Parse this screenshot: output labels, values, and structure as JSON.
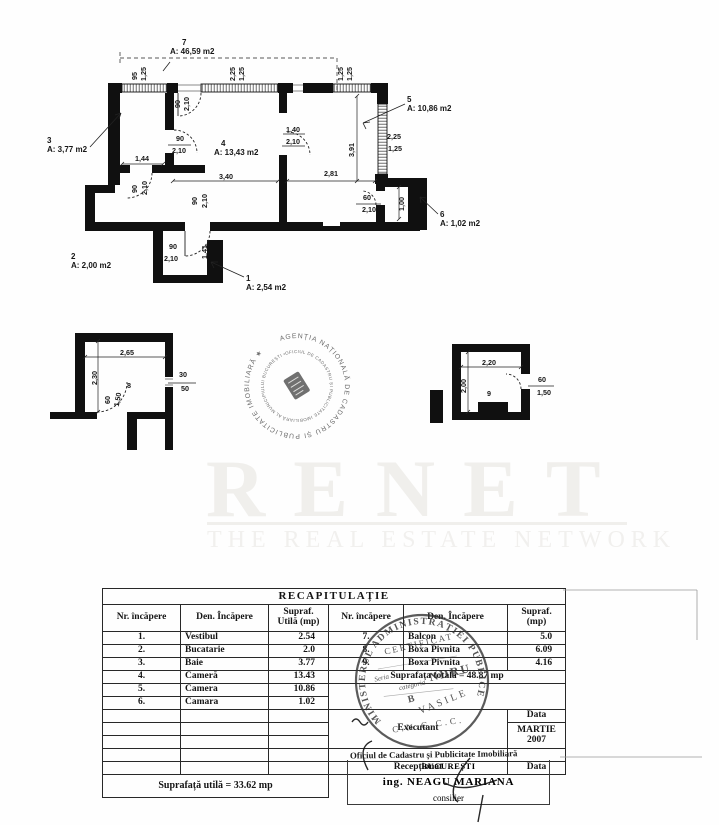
{
  "page": {
    "ink": "#1a1a1a",
    "paper": "#fefefe"
  },
  "watermark": {
    "title": "RENET",
    "subtitle": "THE REAL ESTATE NETWORK"
  },
  "floorplan": {
    "labels": [
      {
        "t": "7",
        "x": 182,
        "y": 45,
        "a": "s",
        "s": 8
      },
      {
        "t": "A: 46,59 m2",
        "x": 170,
        "y": 54,
        "a": "s",
        "s": 8
      },
      {
        "t": "95",
        "x": 137,
        "y": 76,
        "r": -90
      },
      {
        "t": "1,25",
        "x": 146,
        "y": 74,
        "r": -90
      },
      {
        "t": "2,25",
        "x": 235,
        "y": 74,
        "r": -90
      },
      {
        "t": "1,25",
        "x": 244,
        "y": 74,
        "r": -90
      },
      {
        "t": "1,25",
        "x": 343,
        "y": 74,
        "r": -90
      },
      {
        "t": "1,25",
        "x": 352,
        "y": 74,
        "r": -90
      },
      {
        "t": "90",
        "x": 180,
        "y": 104,
        "r": -90
      },
      {
        "t": "2,10",
        "x": 189,
        "y": 104,
        "r": -90
      },
      {
        "t": "3",
        "x": 47,
        "y": 143,
        "a": "s",
        "s": 8
      },
      {
        "t": "A: 3,77 m2",
        "x": 47,
        "y": 152,
        "a": "s",
        "s": 8
      },
      {
        "t": "4",
        "x": 221,
        "y": 146,
        "a": "s",
        "s": 8
      },
      {
        "t": "A: 13,43 m2",
        "x": 214,
        "y": 155,
        "a": "s",
        "s": 8
      },
      {
        "t": "5",
        "x": 407,
        "y": 102,
        "a": "s",
        "s": 8
      },
      {
        "t": "A: 10,86 m2",
        "x": 407,
        "y": 111,
        "a": "s",
        "s": 8
      },
      {
        "t": "1,40",
        "x": 293,
        "y": 132
      },
      {
        "t": "2,10",
        "x": 293,
        "y": 144
      },
      {
        "t": "2,25",
        "x": 394,
        "y": 139
      },
      {
        "t": "1,25",
        "x": 395,
        "y": 151
      },
      {
        "t": "3,91",
        "x": 354,
        "y": 150,
        "r": -90
      },
      {
        "t": "1,44",
        "x": 142,
        "y": 161
      },
      {
        "t": "90",
        "x": 180,
        "y": 141
      },
      {
        "t": "2,10",
        "x": 179,
        "y": 153
      },
      {
        "t": "3,40",
        "x": 226,
        "y": 179
      },
      {
        "t": "2,81",
        "x": 331,
        "y": 176
      },
      {
        "t": "90",
        "x": 137,
        "y": 189,
        "r": -90
      },
      {
        "t": "2,10",
        "x": 147,
        "y": 188,
        "r": -90
      },
      {
        "t": "90",
        "x": 197,
        "y": 201,
        "r": -90
      },
      {
        "t": "2,10",
        "x": 207,
        "y": 201,
        "r": -90
      },
      {
        "t": "60",
        "x": 367,
        "y": 200
      },
      {
        "t": "2,10",
        "x": 369,
        "y": 212
      },
      {
        "t": "1,00",
        "x": 404,
        "y": 204,
        "r": -90
      },
      {
        "t": "6",
        "x": 440,
        "y": 217,
        "a": "s",
        "s": 8
      },
      {
        "t": "A: 1,02 m2",
        "x": 440,
        "y": 226,
        "a": "s",
        "s": 8
      },
      {
        "t": "2",
        "x": 71,
        "y": 259,
        "a": "s",
        "s": 8
      },
      {
        "t": "A: 2,00 m2",
        "x": 71,
        "y": 268,
        "a": "s",
        "s": 8
      },
      {
        "t": "90",
        "x": 173,
        "y": 249
      },
      {
        "t": "2,10",
        "x": 171,
        "y": 261
      },
      {
        "t": "1,41",
        "x": 207,
        "y": 252,
        "r": -90
      },
      {
        "t": "1",
        "x": 246,
        "y": 281,
        "a": "s",
        "s": 8
      },
      {
        "t": "A: 2,54 m2",
        "x": 246,
        "y": 290,
        "a": "s",
        "s": 8
      },
      {
        "t": "2,65",
        "x": 127,
        "y": 355
      },
      {
        "t": "2,30",
        "x": 97,
        "y": 378,
        "r": -90
      },
      {
        "t": "8",
        "x": 129,
        "y": 388
      },
      {
        "t": "30",
        "x": 183,
        "y": 377
      },
      {
        "t": "50",
        "x": 185,
        "y": 391
      },
      {
        "t": "60",
        "x": 110,
        "y": 400,
        "r": -90
      },
      {
        "t": "1,50",
        "x": 120,
        "y": 400,
        "r": -80
      },
      {
        "t": "2,20",
        "x": 489,
        "y": 365
      },
      {
        "t": "2,00",
        "x": 466,
        "y": 386,
        "r": -90
      },
      {
        "t": "9",
        "x": 489,
        "y": 396
      },
      {
        "t": "60",
        "x": 542,
        "y": 382
      },
      {
        "t": "1,50",
        "x": 544,
        "y": 395
      }
    ]
  },
  "stamps": {
    "cadastre": {
      "outer": "AGENȚIA NAȚIONALĂ DE CADASTRU ȘI PUBLICITATE IMOBILIARĂ ★",
      "inner": "OFICIUL DE CADASTRU ȘI PUBLICITATE IMOBILIARĂ AL MUNICIPIULUI BUCUREȘTI •"
    },
    "certificate": {
      "ring": "MINISTERUL  ADMINISTRAȚIEI  PUBLICE",
      "line1": "CERTIFICAT",
      "line2": "Seria",
      "line3": "categoria",
      "line4": "B",
      "line5": "NDRU",
      "line6": "VASILE",
      "line7": "C.N.G.C.C."
    }
  },
  "table": {
    "title": "RECAPITULAȚIE",
    "header": {
      "no": "Nr. încăpere",
      "name": "Den. Încăpere",
      "area1_l1": "Supraf.",
      "area1_l2": "Utilă (mp)",
      "no2": "Nr. încăpere",
      "name2": "Den. Încăpere",
      "area2_l1": "Supraf.",
      "area2_l2": "(mp)"
    },
    "left_rows": [
      {
        "no": "1.",
        "name": "Vestibul",
        "area": "2.54"
      },
      {
        "no": "2.",
        "name": "Bucatarie",
        "area": "2.0"
      },
      {
        "no": "3.",
        "name": "Baie",
        "area": "3.77"
      },
      {
        "no": "4.",
        "name": "Cameră",
        "area": "13.43"
      },
      {
        "no": "5.",
        "name": "Camera",
        "area": "10.86"
      },
      {
        "no": "6.",
        "name": "Camara",
        "area": "1.02"
      }
    ],
    "right_rows": [
      {
        "no": "7.",
        "name": "Balcon",
        "area": "5.0"
      },
      {
        "no": "8.",
        "name": "Boxa Pivnita",
        "area": "6.09"
      },
      {
        "no": "9.",
        "name": "Boxa Pivnita",
        "area": "4.16"
      }
    ],
    "total_right": "Suprafața totală = 48.87 mp",
    "executant": "Executant",
    "data1": "Data",
    "month": "MARTIE",
    "year": "2007",
    "receptionat": "Recepționat",
    "data2": "Data",
    "total_left": "Suprafață utilă = 33.62 mp",
    "office": "Oficiul de Cadastru și Publicitate Imobiliară",
    "city": "BUCUREȘTI",
    "engineer": "ing. NEAGU MARIANA",
    "engineer_title": "consilier"
  }
}
